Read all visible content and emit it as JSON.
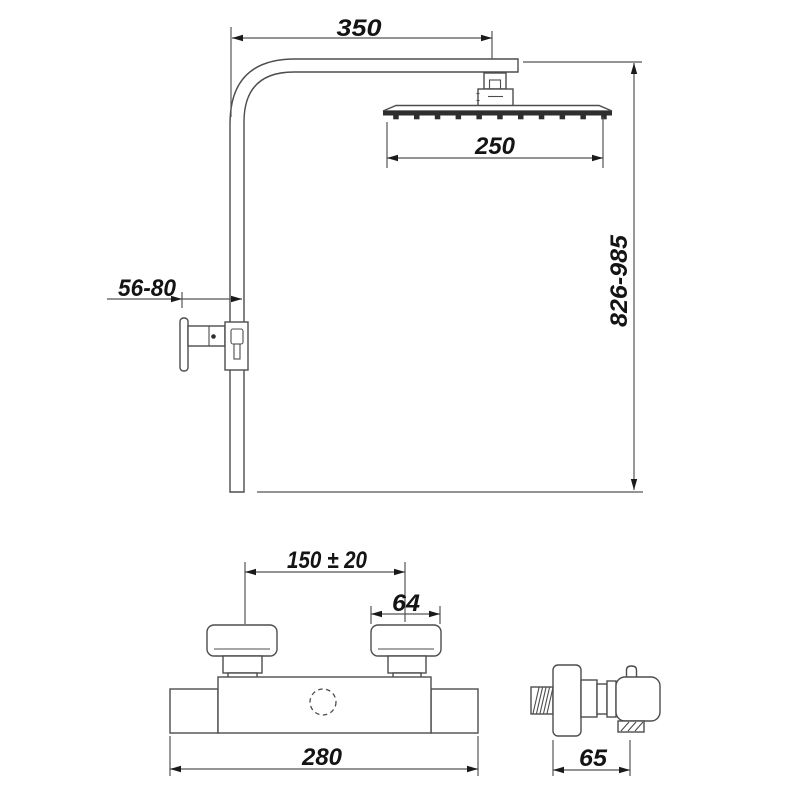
{
  "drawing": {
    "type": "technical-dimension-drawing",
    "subject": "thermostatic shower column with overhead rain shower and wall-mounted mixer",
    "colors": {
      "background": "#ffffff",
      "line": "#4d4d4d",
      "text": "#141414",
      "dark_fill": "#2e2e2e"
    },
    "dimensions": {
      "arm_reach": "350",
      "head_width": "250",
      "height_range": "826-985",
      "wall_distance": "56-80",
      "handle_spacing": "150 ± 20",
      "handle_width": "64",
      "body_width": "280",
      "mixer_depth": "65"
    }
  }
}
